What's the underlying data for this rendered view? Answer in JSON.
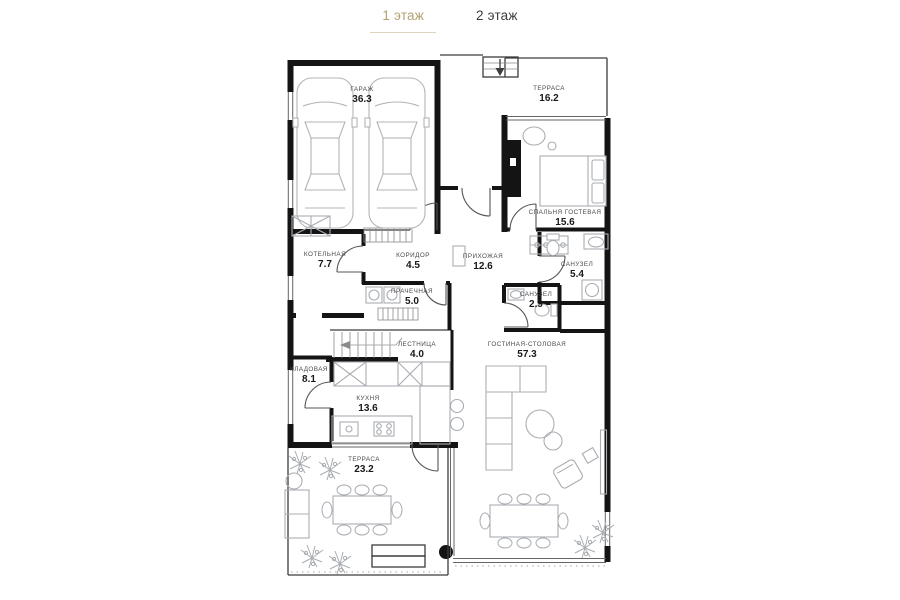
{
  "accent_color": "#b2a172",
  "tabs": [
    {
      "label": "1 этаж",
      "active": true
    },
    {
      "label": "2 этаж",
      "active": false
    }
  ],
  "floor_plan": {
    "floor": "1 этаж",
    "rooms": [
      {
        "name": "ГАРАЖ",
        "area": "36.3"
      },
      {
        "name": "ТЕРРАСА",
        "area": "16.2"
      },
      {
        "name": "СПАЛЬНЯ ГОСТЕВАЯ",
        "area": "15.6"
      },
      {
        "name": "КОТЕЛЬНАЯ",
        "area": "7.7"
      },
      {
        "name": "КОРИДОР",
        "area": "4.5"
      },
      {
        "name": "ПРИХОЖАЯ",
        "area": "12.6"
      },
      {
        "name": "САНУЗЕЛ",
        "area": "5.4"
      },
      {
        "name": "ПРАЧЕЧНАЯ",
        "area": "5.0"
      },
      {
        "name": "САНУЗЕЛ",
        "area": "2.9"
      },
      {
        "name": "ЛЕСТНИЦА",
        "area": "4.0"
      },
      {
        "name": "ГОСТИНАЯ-СТОЛОВАЯ",
        "area": "57.3"
      },
      {
        "name": "КЛАДОВАЯ",
        "area": "8.1"
      },
      {
        "name": "КУХНЯ",
        "area": "13.6"
      },
      {
        "name": "ТЕРРАСА",
        "area": "23.2"
      }
    ]
  }
}
